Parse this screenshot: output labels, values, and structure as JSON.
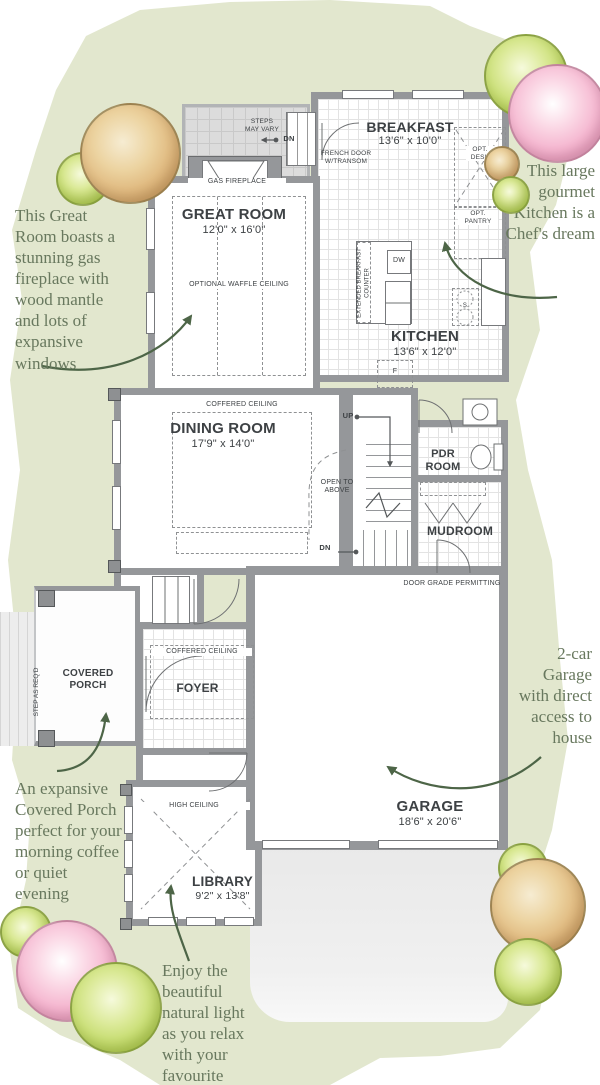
{
  "rooms": {
    "breakfast": {
      "name": "BREAKFAST",
      "dims": "13'6\" x 10'0\""
    },
    "great_room": {
      "name": "GREAT ROOM",
      "dims": "12'0\" x 16'0\""
    },
    "kitchen": {
      "name": "KITCHEN",
      "dims": "13'6\" x 12'0\""
    },
    "dining_room": {
      "name": "DINING ROOM",
      "dims": "17'9\" x 14'0\""
    },
    "pdr_room": {
      "name": "PDR ROOM"
    },
    "mudroom": {
      "name": "MUDROOM"
    },
    "foyer": {
      "name": "FOYER"
    },
    "covered_porch": {
      "name": "COVERED PORCH"
    },
    "library": {
      "name": "LIBRARY",
      "dims": "9'2\" x 13'8\""
    },
    "garage": {
      "name": "GARAGE",
      "dims": "18'6\" x 20'6\""
    }
  },
  "labels": {
    "gas_fireplace": "GAS FIREPLACE",
    "optional_waffle_ceiling": "OPTIONAL WAFFLE CEILING",
    "coffered_ceiling_dining": "COFFERED CEILING",
    "coffered_ceiling_foyer": "COFFERED CEILING",
    "high_ceiling": "HIGH CEILING",
    "french_door": "FRENCH DOOR W/TRANSOM",
    "steps_may_vary": "STEPS MAY VARY",
    "opt_desk": "OPT. DESK",
    "opt_pantry": "OPT. PANTRY",
    "extended_breakfast_counter": "EXTENDED BREAKFAST COUNTER",
    "dishwasher": "DW",
    "fridge": "F",
    "sink": "S",
    "up": "UP",
    "dn_upper": "DN",
    "dn_lower": "DN",
    "open_to_above": "OPEN TO ABOVE",
    "door_grade_permitting": "DOOR GRADE PERMITTING",
    "step_as_reqd": "STEP AS REQ'D"
  },
  "annotations": {
    "great_room": "This Great Room boasts a stunning gas fireplace with wood mantle and lots of expansive windows",
    "kitchen": "This large gourmet Kitchen is a Chef's dream",
    "garage": "2-car Garage with direct access to house",
    "porch": "An expansive Covered Porch perfect for your morning coffee or quiet evening",
    "library": "Enjoy the beautiful natural light as you relax with your favourite book"
  },
  "colors": {
    "lawn": "#e2e7ce",
    "wall": "#95979a",
    "annotation_text": "#68785e",
    "arrow": "#4d6547",
    "tree_tan": "#d8a96b",
    "tree_pink": "#f2a7c6",
    "tree_green": "#b8d455"
  }
}
